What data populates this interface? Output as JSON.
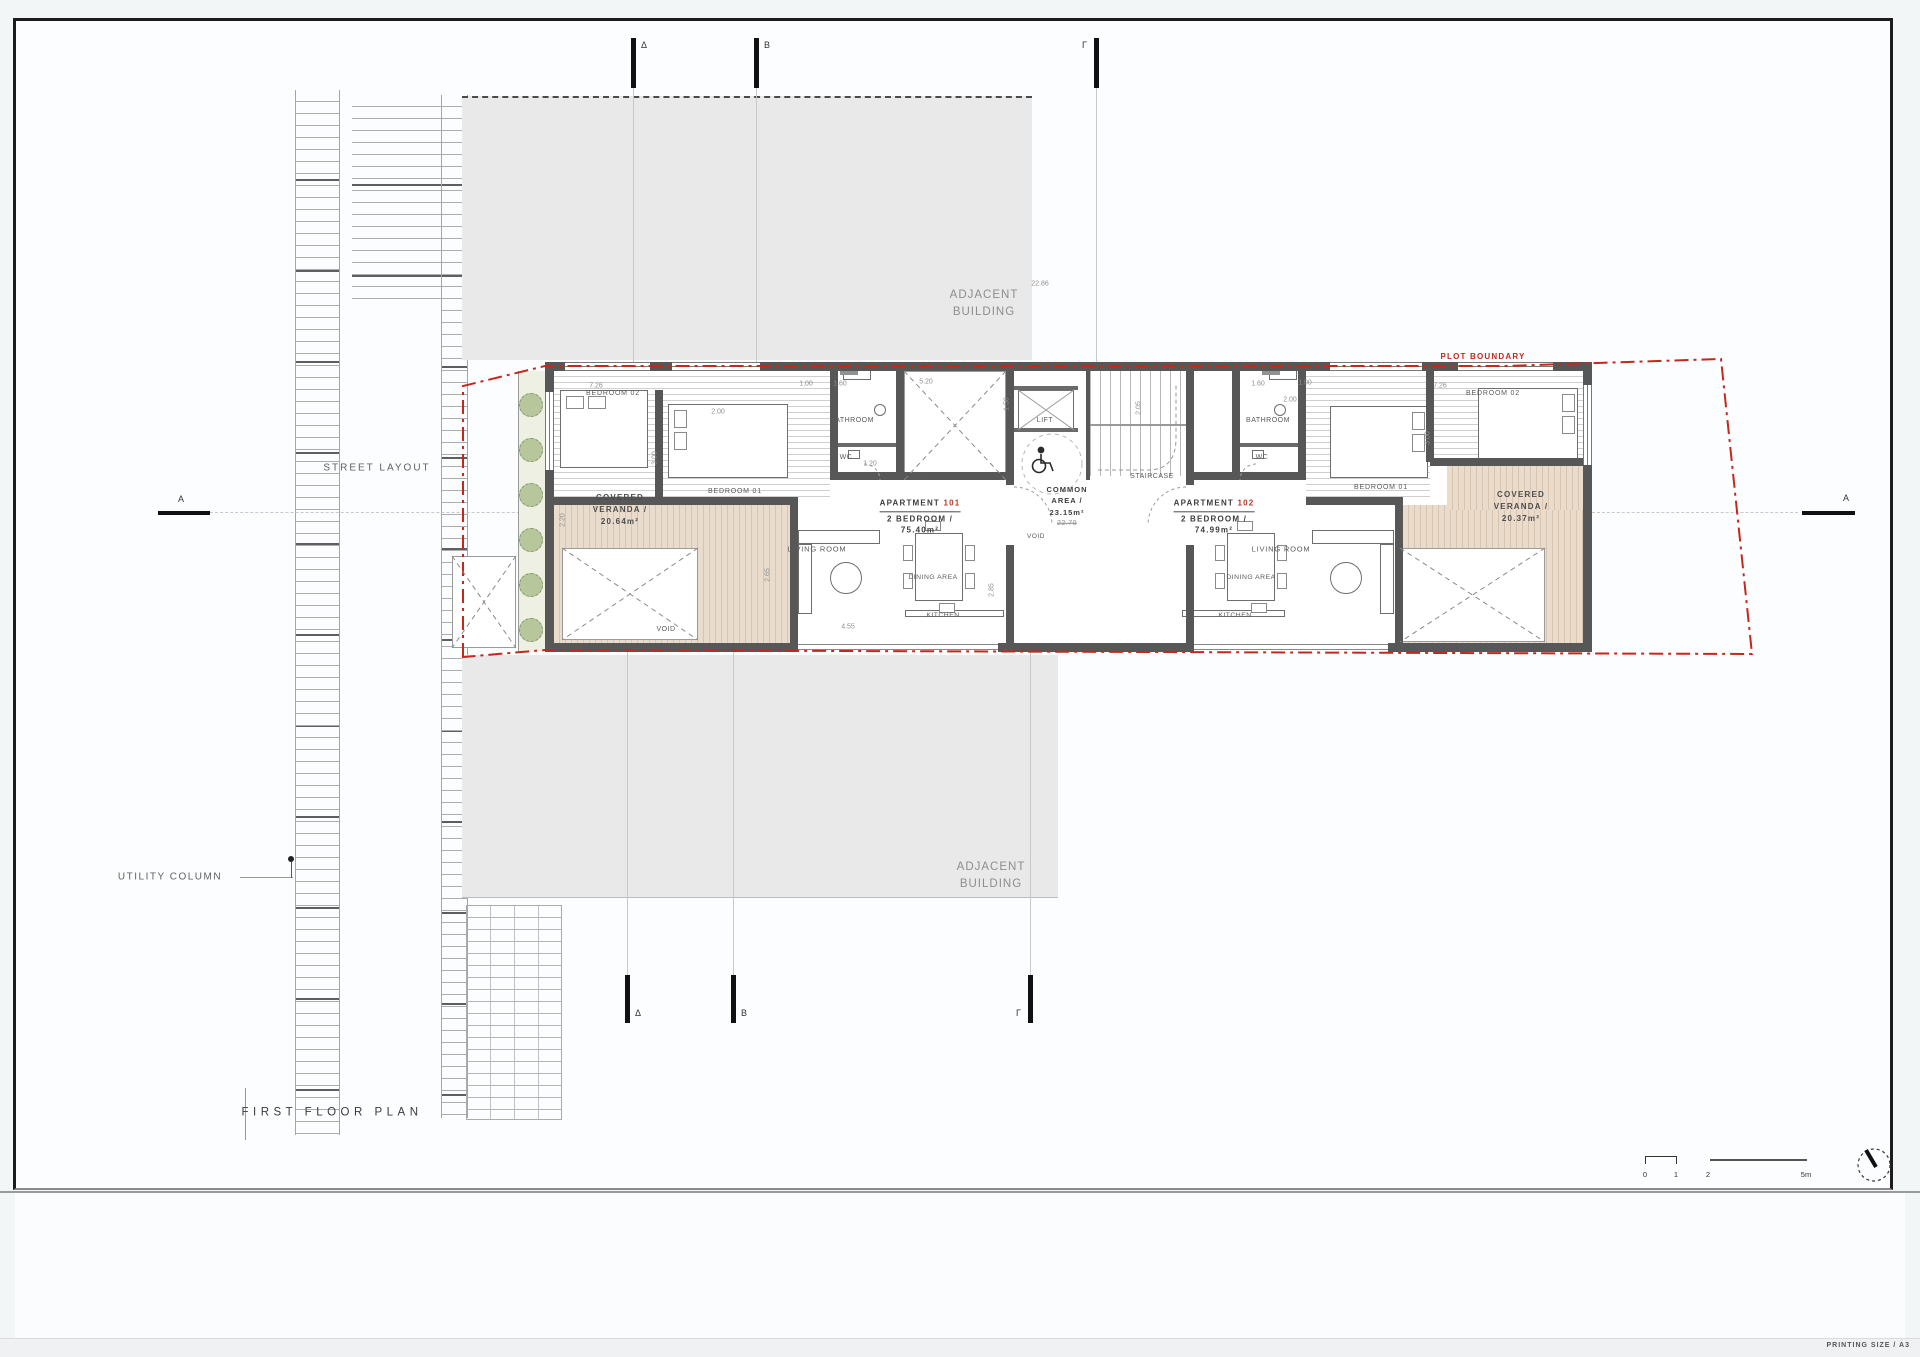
{
  "sheet": {
    "printing_size": "PRINTING SIZE / A3"
  },
  "colors": {
    "plot_boundary_red": "#c4281d",
    "apartment_number_red": "#b8382a",
    "wall_gray": "#575757",
    "adjacent_building_gray": "#e9e9e9",
    "veranda_tan": "#e0cfbc",
    "planting_green": "#b7c69b"
  },
  "apartments": {
    "apt101": {
      "prefix": "APARTMENT",
      "number": "101",
      "line2": "2 BEDROOM /",
      "area": "75.40m²"
    },
    "apt102": {
      "prefix": "APARTMENT",
      "number": "102",
      "line2": "2 BEDROOM /",
      "area": "74.99m²"
    }
  },
  "labels": [
    {
      "n": "street-layout-label",
      "t": "STREET LAYOUT",
      "x": 377,
      "y": 468,
      "s": 10,
      "ls": 2,
      "c": "#606060"
    },
    {
      "n": "utility-column-label",
      "t": "UTILITY COLUMN",
      "x": 170,
      "y": 877,
      "s": 10,
      "ls": 1.5,
      "c": "#606060"
    },
    {
      "n": "plan-title",
      "t": "FIRST FLOOR PLAN",
      "x": 332,
      "y": 1113,
      "s": 11.5,
      "ls": 4.5,
      "c": "#3b3b3b"
    },
    {
      "n": "plot-boundary-label",
      "t": "PLOT BOUNDARY",
      "x": 1483,
      "y": 357,
      "s": 8,
      "ls": 1.2,
      "c": "#c4281d",
      "b": 1
    },
    {
      "n": "adjacent-building-label-top",
      "t": "ADJACENT\nBUILDING",
      "x": 984,
      "y": 304,
      "s": 11.5,
      "ls": 1,
      "c": "#8d8d8d"
    },
    {
      "n": "adjacent-building-label-bottom",
      "t": "ADJACENT\nBUILDING",
      "x": 991,
      "y": 876,
      "s": 11.5,
      "ls": 1,
      "c": "#8d8d8d"
    },
    {
      "n": "covered-veranda-left-label",
      "t": "COVERED\nVERANDA /\n20.64m²",
      "x": 620,
      "y": 510,
      "s": 8,
      "ls": 1.2,
      "c": "#4c4c4c",
      "b": 1
    },
    {
      "n": "covered-veranda-right-label",
      "t": "COVERED\nVERANDA /\n20.37m²",
      "x": 1521,
      "y": 507,
      "s": 8,
      "ls": 1.2,
      "c": "#4c4c4c",
      "b": 1
    },
    {
      "n": "common-area-label",
      "t": "COMMON\nAREA /\n23.15m²",
      "x": 1067,
      "y": 501,
      "s": 7.5,
      "ls": 1,
      "c": "#3d3d3d",
      "b": 1
    },
    {
      "n": "common-area-old-value",
      "t": "22.70",
      "x": 1067,
      "y": 524,
      "s": 7,
      "c": "#8a8a8a",
      "strike": 1
    },
    {
      "n": "bedroom-02-left-label",
      "t": "BEDROOM 02",
      "x": 613,
      "y": 394,
      "s": 7,
      "ls": 0.8
    },
    {
      "n": "bedroom-01-left-label",
      "t": "BEDROOM 01",
      "x": 735,
      "y": 492,
      "s": 7,
      "ls": 0.8
    },
    {
      "n": "bathroom-left-label",
      "t": "BATHROOM",
      "x": 852,
      "y": 421,
      "s": 7,
      "ls": 0.5
    },
    {
      "n": "wc-left-label",
      "t": "WC",
      "x": 846,
      "y": 458,
      "s": 7,
      "ls": 0.5
    },
    {
      "n": "staircase-left-label",
      "t": "STAIRCASE",
      "x": 927,
      "y": 477,
      "s": 7,
      "ls": 0.5
    },
    {
      "n": "living-room-left-label",
      "t": "LIVING ROOM",
      "x": 817,
      "y": 549,
      "s": 7.5,
      "ls": 0.8
    },
    {
      "n": "dining-area-left-label",
      "t": "DINING AREA",
      "x": 933,
      "y": 578,
      "s": 6.8,
      "ls": 0.5
    },
    {
      "n": "kitchen-left-label",
      "t": "KITCHEN",
      "x": 943,
      "y": 616,
      "s": 6.8,
      "ls": 0.5
    },
    {
      "n": "void-left-label",
      "t": "VOID",
      "x": 666,
      "y": 630,
      "s": 7,
      "ls": 0.5
    },
    {
      "n": "lift-label",
      "t": "LIFT",
      "x": 1045,
      "y": 421,
      "s": 7,
      "ls": 0.5
    },
    {
      "n": "void-common-label",
      "t": "VOID",
      "x": 1036,
      "y": 537,
      "s": 6.5,
      "ls": 0.5
    },
    {
      "n": "staircase-common-label",
      "t": "STAIRCASE",
      "x": 1152,
      "y": 477,
      "s": 7,
      "ls": 0.5
    },
    {
      "n": "bathroom-right-label",
      "t": "BATHROOM",
      "x": 1268,
      "y": 421,
      "s": 7,
      "ls": 0.5
    },
    {
      "n": "wc-right-label",
      "t": "WC",
      "x": 1262,
      "y": 458,
      "s": 7,
      "ls": 0.5
    },
    {
      "n": "bedroom-01-right-label",
      "t": "BEDROOM 01",
      "x": 1381,
      "y": 488,
      "s": 7,
      "ls": 0.8
    },
    {
      "n": "bedroom-02-right-label",
      "t": "BEDROOM 02",
      "x": 1493,
      "y": 394,
      "s": 7,
      "ls": 0.8
    },
    {
      "n": "living-room-right-label",
      "t": "LIVING ROOM",
      "x": 1281,
      "y": 549,
      "s": 7.5,
      "ls": 0.8
    },
    {
      "n": "dining-area-right-label",
      "t": "DINING AREA",
      "x": 1251,
      "y": 578,
      "s": 6.8,
      "ls": 0.5
    },
    {
      "n": "kitchen-right-label",
      "t": "KITCHEN",
      "x": 1235,
      "y": 616,
      "s": 6.8,
      "ls": 0.5
    }
  ],
  "dims": [
    {
      "t": "22.86",
      "x": 1040,
      "y": 284
    },
    {
      "t": "7.26",
      "x": 596,
      "y": 386
    },
    {
      "t": "1.00",
      "x": 806,
      "y": 384
    },
    {
      "t": "1.60",
      "x": 840,
      "y": 384
    },
    {
      "t": "5.20",
      "x": 926,
      "y": 382
    },
    {
      "t": "1.60",
      "x": 1258,
      "y": 384
    },
    {
      "t": "1.00",
      "x": 1305,
      "y": 383
    },
    {
      "t": "7.26",
      "x": 1440,
      "y": 386
    },
    {
      "t": "2.00",
      "x": 718,
      "y": 412
    },
    {
      "t": "2.00",
      "x": 1290,
      "y": 400
    },
    {
      "t": "3.00",
      "x": 655,
      "y": 458,
      "rot": 1
    },
    {
      "t": "3.00",
      "x": 1428,
      "y": 438,
      "rot": 1
    },
    {
      "t": "2.05",
      "x": 1139,
      "y": 408,
      "rot": 1
    },
    {
      "t": "1.20",
      "x": 870,
      "y": 464
    },
    {
      "t": "1.50",
      "x": 1007,
      "y": 404,
      "rot": 1
    },
    {
      "t": "2.65",
      "x": 768,
      "y": 575,
      "rot": 1
    },
    {
      "t": "2.85",
      "x": 992,
      "y": 590,
      "rot": 1
    },
    {
      "t": "4.55",
      "x": 848,
      "y": 627
    },
    {
      "t": "2.20",
      "x": 563,
      "y": 520,
      "rot": 1
    }
  ],
  "markers": {
    "top": [
      {
        "t": "Δ",
        "x": 633,
        "side": "r"
      },
      {
        "t": "B",
        "x": 756,
        "side": "r"
      },
      {
        "t": "Γ",
        "x": 1096,
        "side": "l"
      }
    ],
    "bottom": [
      {
        "t": "Δ",
        "x": 627,
        "side": "r"
      },
      {
        "t": "B",
        "x": 733,
        "side": "r"
      },
      {
        "t": "Γ",
        "x": 1030,
        "side": "l"
      }
    ],
    "left": {
      "t": "A"
    },
    "right": {
      "t": "A"
    }
  },
  "scalebar": {
    "ticks": [
      {
        "t": "0",
        "x": 1645
      },
      {
        "t": "1",
        "x": 1676
      },
      {
        "t": "2",
        "x": 1708
      },
      {
        "t": "5m",
        "x": 1806
      }
    ]
  }
}
